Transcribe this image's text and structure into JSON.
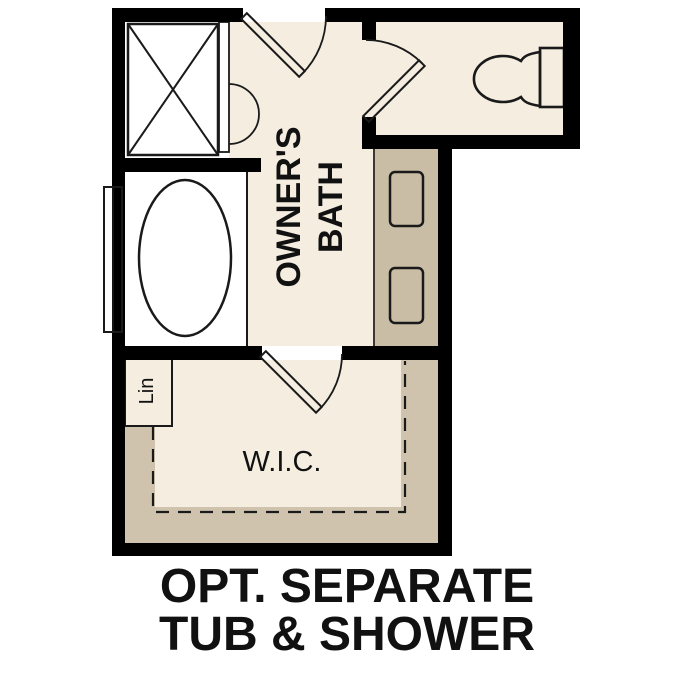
{
  "figure": {
    "type": "floor-plan",
    "caption_line1": "OPT. SEPARATE",
    "caption_line2": "TUB & SHOWER"
  },
  "rooms": {
    "owners_bath": {
      "label_line1": "OWNER'S",
      "label_line2": "BATH"
    },
    "walk_in_closet": {
      "label": "W.I.C."
    },
    "linen_closet": {
      "label": "Lin"
    }
  },
  "fixtures": [
    "shower-with-glass-door",
    "bathtub",
    "window",
    "double-vanity-sinks",
    "toilet",
    "closet-shelves-with-rod",
    "door-swings"
  ],
  "colors": {
    "floor_cream": "#f4ede0",
    "counter_tan": "#c9bda5",
    "shelf_tan": "#cfc3ad",
    "fixture_blue": "#a9c9e9",
    "wall_black": "#000000",
    "outline_dark": "#1a1a1a",
    "text": "#111111"
  }
}
